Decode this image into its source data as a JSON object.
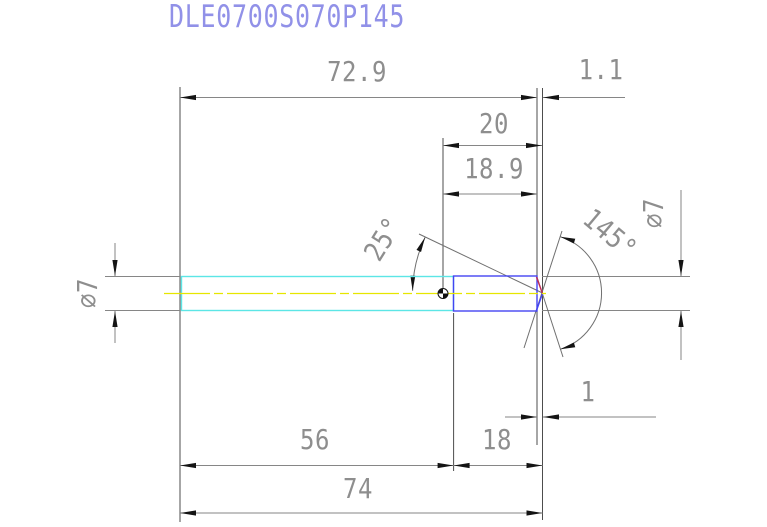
{
  "title": "DLE0700S070P145",
  "colors": {
    "background": "#ffffff",
    "title_text": "#9191e8",
    "dim_line": "#868686",
    "dim_text": "#8e8e8e",
    "extension_line": "#4d4d4d",
    "arrow": "#141414",
    "shank_outline": "#5ce6e6",
    "flute_outline": "#4444f2",
    "centerline": "#e6e600",
    "tip_edge_upper": "#c12b55",
    "tip_edge_lower": "#4444f2",
    "angle_line": "#6f6f6f"
  },
  "drawing": {
    "dimensions": {
      "overall_to_shoulder": "72.9",
      "tip_length_top": "1.1",
      "point_to_tip": "20",
      "point_to_shoulder": "18.9",
      "flute_angle": "25°",
      "point_angle": "145°",
      "diameter_left": "⌀7",
      "diameter_right": "⌀7",
      "tip_length_bottom": "1",
      "shank_length": "56",
      "flute_length": "18",
      "overall_length": "74"
    }
  }
}
